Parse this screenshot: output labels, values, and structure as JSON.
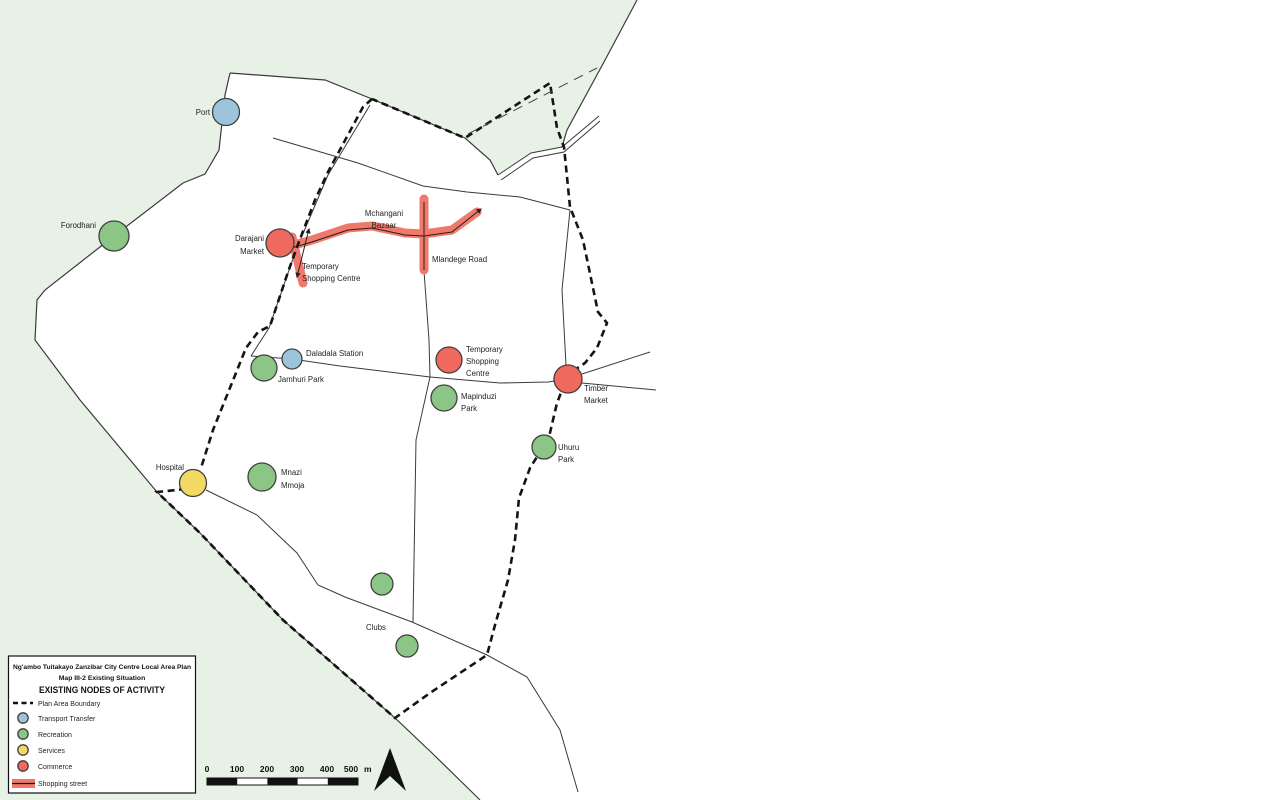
{
  "colors": {
    "sea": "#e7f1e6",
    "transport": "#9cc5dc",
    "recreation": "#8bc687",
    "services": "#f1d964",
    "commerce": "#f0695e",
    "shopping_street": "#f1796c"
  },
  "labels": {
    "port": "Port",
    "forodhani": "Forodhani",
    "darajani_1": "Darajani",
    "darajani_2": "Market",
    "temp_centre_west_1": "Temporary",
    "temp_centre_west_2": "Shopping Centre",
    "mchangani_1": "Mchangani",
    "mchangani_2": "Bazaar",
    "mlandege": "Mlandege Road",
    "daladala": "Daladala Station",
    "jamhuri": "Jamhuri Park",
    "temp_centre_east_1": "Temporary",
    "temp_centre_east_2": "Shopping",
    "temp_centre_east_3": "Centre",
    "timber_1": "Timber",
    "timber_2": "Market",
    "mapinduzi_1": "Mapinduzi",
    "mapinduzi_2": "Park",
    "uhuru_1": "Uhuru",
    "uhuru_2": "Park",
    "hospital": "Hospital",
    "mnazi_1": "Mnazi",
    "mnazi_2": "Mmoja",
    "clubs": "Clubs"
  },
  "legend": {
    "title_line1": "Ng'ambo Tuitakayo Zanzibar City Centre Local Area Plan",
    "title_line2": "Map III-2 Existing Situation",
    "title_line3": "EXISTING NODES OF ACTIVITY",
    "items": [
      {
        "label": "Plan Area Boundary",
        "swatch": "dashed-line"
      },
      {
        "label": "Transport Transfer",
        "swatch": "circle",
        "color_key": "transport"
      },
      {
        "label": "Recreation",
        "swatch": "circle",
        "color_key": "recreation"
      },
      {
        "label": "Services",
        "swatch": "circle",
        "color_key": "services"
      },
      {
        "label": "Commerce",
        "swatch": "circle",
        "color_key": "commerce"
      },
      {
        "label": "Shopping street",
        "swatch": "band",
        "color_key": "shopping_street"
      }
    ]
  },
  "scalebar": {
    "ticks": [
      "0",
      "100",
      "200",
      "300",
      "400",
      "500"
    ],
    "unit": "m"
  }
}
